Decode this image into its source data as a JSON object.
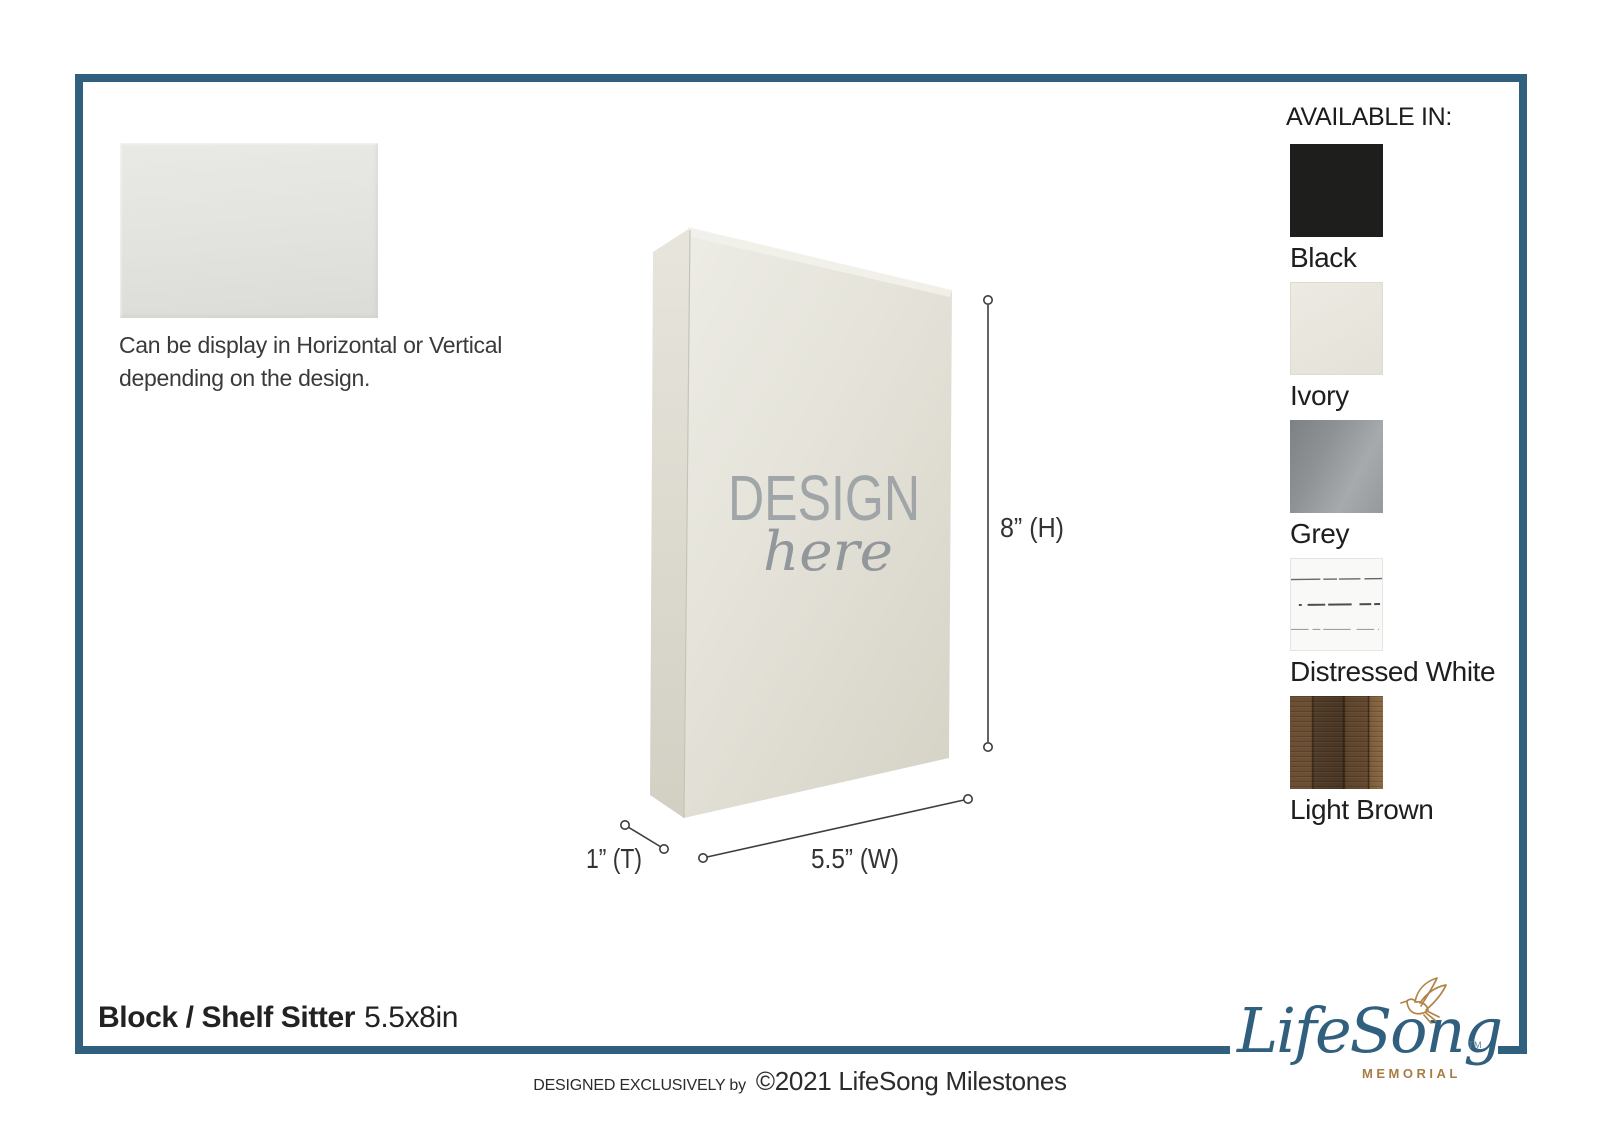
{
  "frame": {
    "accent_color": "#31607e"
  },
  "intro": {
    "caption_line1": "Can be display in Horizontal or Vertical",
    "caption_line2": "depending on the design."
  },
  "block": {
    "watermark_line1": "DESIGN",
    "watermark_line2": "here",
    "face_color": "#e3e1d7"
  },
  "dimensions": {
    "height_label": "8” (H)",
    "width_label": "5.5” (W)",
    "thickness_label": "1” (T)"
  },
  "available_in": {
    "title": "AVAILABLE IN:",
    "options": [
      {
        "name": "Black",
        "hex": "#1e1e1c"
      },
      {
        "name": "Ivory",
        "hex": "#e9e6df"
      },
      {
        "name": "Grey",
        "hex": "#94979a"
      },
      {
        "name": "Distressed White",
        "hex": "#f8f8f6"
      },
      {
        "name": "Light Brown",
        "hex": "#5d452c"
      }
    ]
  },
  "footer": {
    "product_name": "Block / Shelf Sitter",
    "product_size": "5.5x8in",
    "designed_by": "DESIGNED EXCLUSIVELY by",
    "copyright": "©2021 LifeSong Milestones"
  },
  "logo": {
    "brand": "LifeSong",
    "division": "MEMORIAL",
    "trademark": "TM",
    "brand_color": "#31607f",
    "gold_color": "#b08549"
  }
}
